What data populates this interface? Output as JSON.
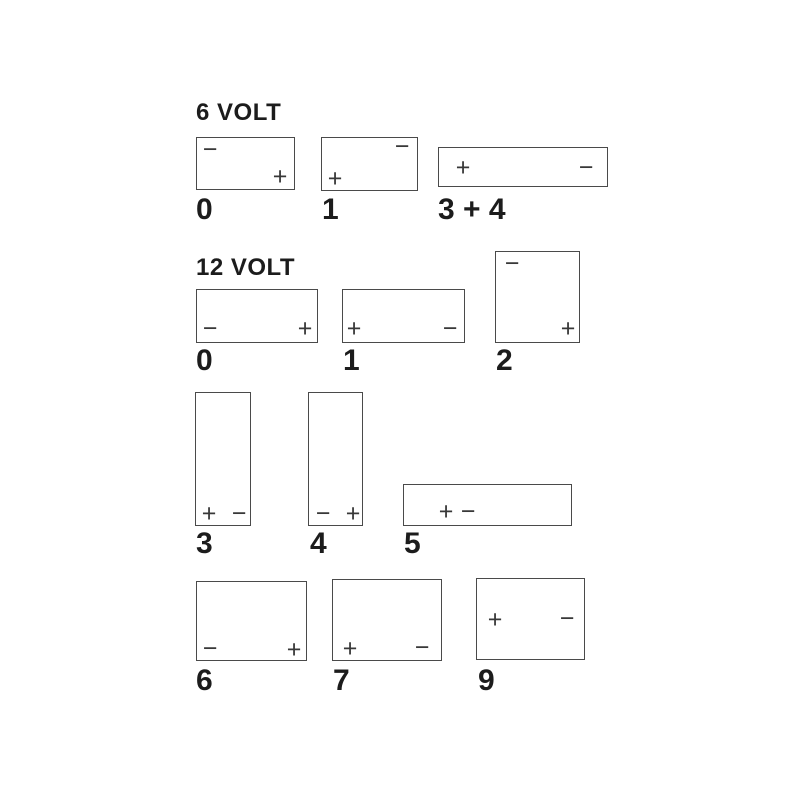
{
  "diagram": {
    "background": "#ffffff",
    "box_border_color": "#4a4a4a",
    "terminal_color": "#383838",
    "text_color": "#1c1c1c",
    "sections": [
      {
        "title": "6 VOLT",
        "title_pos": {
          "x": 196,
          "y": 101
        },
        "batteries": [
          {
            "label": "0",
            "label_pos": {
              "x": 196,
              "y": 195
            },
            "box": {
              "x": 196,
              "y": 137,
              "w": 99,
              "h": 53
            },
            "terminals": [
              {
                "sign": "−",
                "polarity": "minus",
                "x": 209,
                "y": 149
              },
              {
                "sign": "+",
                "polarity": "plus",
                "x": 279,
                "y": 176
              }
            ]
          },
          {
            "label": "1",
            "label_pos": {
              "x": 322,
              "y": 195
            },
            "box": {
              "x": 321,
              "y": 137,
              "w": 97,
              "h": 54
            },
            "terminals": [
              {
                "sign": "−",
                "polarity": "minus",
                "x": 401,
                "y": 146
              },
              {
                "sign": "+",
                "polarity": "plus",
                "x": 334,
                "y": 178
              }
            ]
          },
          {
            "label": "3 + 4",
            "label_pos": {
              "x": 438,
              "y": 195
            },
            "box": {
              "x": 438,
              "y": 147,
              "w": 170,
              "h": 40
            },
            "terminals": [
              {
                "sign": "+",
                "polarity": "plus",
                "x": 462,
                "y": 167
              },
              {
                "sign": "−",
                "polarity": "minus",
                "x": 585,
                "y": 167
              }
            ]
          }
        ]
      },
      {
        "title": "12 VOLT",
        "title_pos": {
          "x": 196,
          "y": 256
        },
        "batteries": [
          {
            "label": "0",
            "label_pos": {
              "x": 196,
              "y": 346
            },
            "box": {
              "x": 196,
              "y": 289,
              "w": 122,
              "h": 54
            },
            "terminals": [
              {
                "sign": "−",
                "polarity": "minus",
                "x": 209,
                "y": 328
              },
              {
                "sign": "+",
                "polarity": "plus",
                "x": 304,
                "y": 328
              }
            ]
          },
          {
            "label": "1",
            "label_pos": {
              "x": 343,
              "y": 346
            },
            "box": {
              "x": 342,
              "y": 289,
              "w": 123,
              "h": 54
            },
            "terminals": [
              {
                "sign": "+",
                "polarity": "plus",
                "x": 353,
                "y": 328
              },
              {
                "sign": "−",
                "polarity": "minus",
                "x": 449,
                "y": 328
              }
            ]
          },
          {
            "label": "2",
            "label_pos": {
              "x": 496,
              "y": 346
            },
            "box": {
              "x": 495,
              "y": 251,
              "w": 85,
              "h": 92
            },
            "terminals": [
              {
                "sign": "−",
                "polarity": "minus",
                "x": 511,
                "y": 263
              },
              {
                "sign": "+",
                "polarity": "plus",
                "x": 567,
                "y": 328
              }
            ]
          },
          {
            "label": "3",
            "label_pos": {
              "x": 196,
              "y": 529
            },
            "box": {
              "x": 195,
              "y": 392,
              "w": 56,
              "h": 134
            },
            "terminals": [
              {
                "sign": "+",
                "polarity": "plus",
                "x": 208,
                "y": 513
              },
              {
                "sign": "−",
                "polarity": "minus",
                "x": 238,
                "y": 513
              }
            ]
          },
          {
            "label": "4",
            "label_pos": {
              "x": 310,
              "y": 529
            },
            "box": {
              "x": 308,
              "y": 392,
              "w": 55,
              "h": 134
            },
            "terminals": [
              {
                "sign": "−",
                "polarity": "minus",
                "x": 322,
                "y": 513
              },
              {
                "sign": "+",
                "polarity": "plus",
                "x": 352,
                "y": 513
              }
            ]
          },
          {
            "label": "5",
            "label_pos": {
              "x": 404,
              "y": 529
            },
            "box": {
              "x": 403,
              "y": 484,
              "w": 169,
              "h": 42
            },
            "terminals": [
              {
                "sign": "+",
                "polarity": "plus",
                "x": 445,
                "y": 511
              },
              {
                "sign": "−",
                "polarity": "minus",
                "x": 467,
                "y": 511
              }
            ]
          },
          {
            "label": "6",
            "label_pos": {
              "x": 196,
              "y": 666
            },
            "box": {
              "x": 196,
              "y": 581,
              "w": 111,
              "h": 80
            },
            "terminals": [
              {
                "sign": "−",
                "polarity": "minus",
                "x": 209,
                "y": 648
              },
              {
                "sign": "+",
                "polarity": "plus",
                "x": 293,
                "y": 649
              }
            ]
          },
          {
            "label": "7",
            "label_pos": {
              "x": 333,
              "y": 666
            },
            "box": {
              "x": 332,
              "y": 579,
              "w": 110,
              "h": 82
            },
            "terminals": [
              {
                "sign": "+",
                "polarity": "plus",
                "x": 349,
                "y": 648
              },
              {
                "sign": "−",
                "polarity": "minus",
                "x": 421,
                "y": 647
              }
            ]
          },
          {
            "label": "9",
            "label_pos": {
              "x": 478,
              "y": 666
            },
            "box": {
              "x": 476,
              "y": 578,
              "w": 109,
              "h": 82
            },
            "terminals": [
              {
                "sign": "+",
                "polarity": "plus",
                "x": 494,
                "y": 619
              },
              {
                "sign": "−",
                "polarity": "minus",
                "x": 566,
                "y": 618
              }
            ]
          }
        ]
      }
    ]
  }
}
